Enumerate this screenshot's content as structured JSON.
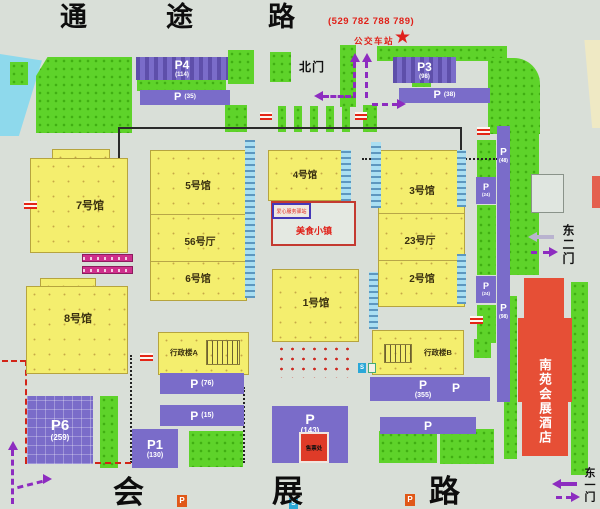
{
  "roads": {
    "top": [
      "通",
      "途",
      "路"
    ],
    "bottom": [
      "会",
      "展",
      "路"
    ]
  },
  "transit": {
    "phone": "(529 782 788 789)",
    "bus_station": "公交车站"
  },
  "gates": {
    "north": "北门",
    "east2": "东二门",
    "east1": "东一门"
  },
  "halls": {
    "h7": "7号馆",
    "h8": "8号馆",
    "h5": "5号馆",
    "h56": "56号厅",
    "h6": "6号馆",
    "h4": "4号馆",
    "h1": "1号馆",
    "h3": "3号馆",
    "h23": "23号厅",
    "h2": "2号馆"
  },
  "buildings": {
    "admin_a": "行政楼A",
    "admin_b": "行政楼B",
    "hotel": "南苑会展酒店",
    "food_town": "美食小镇",
    "service_station": "爱心服务驿站",
    "ticket_office": "售票处"
  },
  "parking": {
    "p4": {
      "name": "P4",
      "count": "(114)"
    },
    "p35": {
      "name": "P",
      "count": "(35)"
    },
    "p3": {
      "name": "P3",
      "count": "(98)"
    },
    "p38": {
      "name": "P",
      "count": "(38)"
    },
    "p48": {
      "name": "P",
      "count": "(48)"
    },
    "p98": {
      "name": "P",
      "count": "(98)"
    },
    "p24a": {
      "name": "P",
      "count": "(24)"
    },
    "p24b": {
      "name": "P",
      "count": "(24)"
    },
    "p76": {
      "name": "P",
      "count": "(76)"
    },
    "p15": {
      "name": "P",
      "count": "(15)"
    },
    "p6": {
      "name": "P6",
      "count": "(259)"
    },
    "p1": {
      "name": "P1",
      "count": "(130)"
    },
    "p143": {
      "name": "P",
      "count": "(143)"
    },
    "p355": {
      "name": "P",
      "count": "(355)"
    },
    "p355b": {
      "name": "P",
      "count": ""
    },
    "psouth": {
      "name": "P",
      "count": ""
    }
  },
  "markers": {
    "star": "★",
    "p_small": "P",
    "s_small": "S"
  }
}
